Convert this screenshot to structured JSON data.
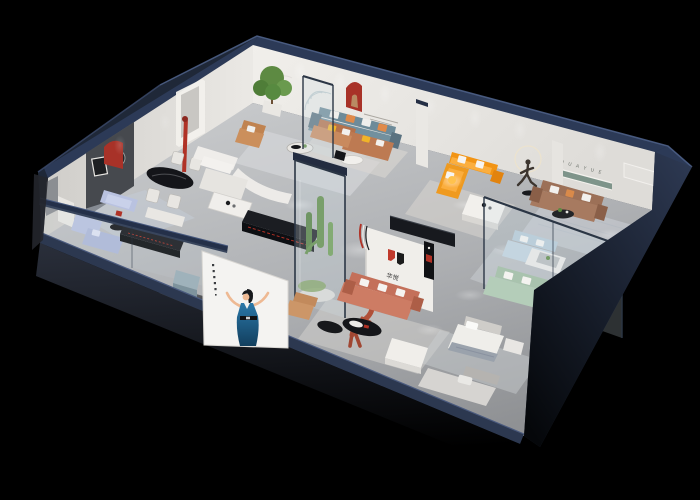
{
  "title": "3D isometric cutaway render of a furniture showroom",
  "background": "#000000",
  "brand": {
    "wall_letters": "H U A Y U E",
    "logo_text": "华悦"
  },
  "palette": {
    "shell": "#1f2838",
    "shellTop": "#2c3a57",
    "floorLight": "#c6c8ca",
    "floorDark": "#94969a",
    "wall": "#e9e7e3",
    "wallShade": "#dbd9d5",
    "accentPanel": "#46494e",
    "nicheRed": "#a83228",
    "sofaOrange": "#f29414",
    "sofaTeal": "#6e8b99",
    "sofaPeriwinkle": "#b9c2e0",
    "sofaCaramel": "#b5714a",
    "sofaBrown": "#9c7057",
    "sofaSalmon": "#c4705a",
    "sofaMint": "#a9c3ae",
    "sofaPaleBlue": "#b6c9d6",
    "sofaWhite": "#efedea",
    "pillowYellow": "#f0b429",
    "pillowOrange": "#e08a4a",
    "plantGreen": "#5d8a42",
    "glassTint": "#cfe0e6",
    "glassFrame": "#2b3645",
    "black": "#141519",
    "statueBronze": "#3c352f",
    "figureClay": "#b05039",
    "posterWhite": "#f4f3f1",
    "dressBlue": "#1d5f8a",
    "shelfGreen": "#7e948a",
    "lampGlow": "#ffc24d"
  }
}
